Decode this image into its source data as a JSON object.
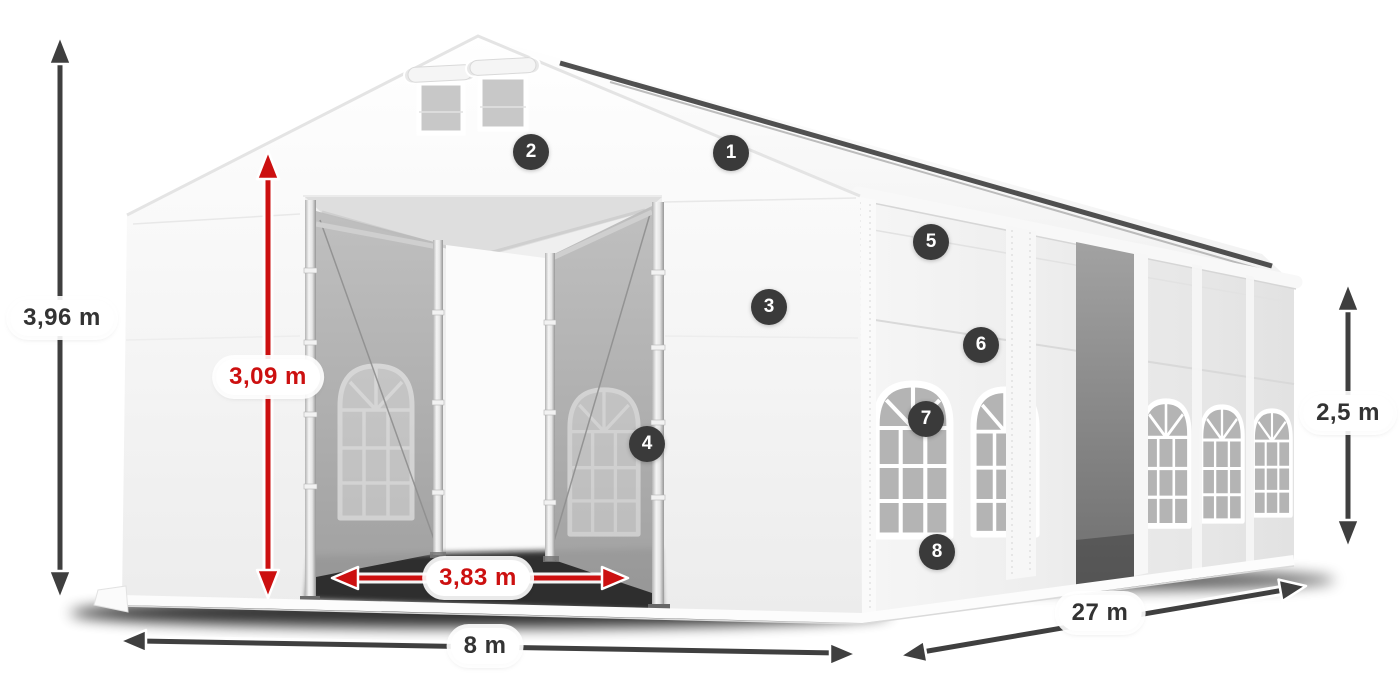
{
  "dimension_labels": {
    "total_height": "3,96 m",
    "entrance_height": "3,09 m",
    "entrance_width": "3,83 m",
    "width": "8 m",
    "length": "27 m",
    "side_height": "2,5 m"
  },
  "markers": [
    {
      "number": "1"
    },
    {
      "number": "2"
    },
    {
      "number": "3"
    },
    {
      "number": "4"
    },
    {
      "number": "5"
    },
    {
      "number": "6"
    },
    {
      "number": "7"
    },
    {
      "number": "8"
    }
  ],
  "colors": {
    "background": "#ffffff",
    "dimension_arrow_dark": "#3f3f3f",
    "dimension_arrow_red": "#cc1010",
    "marker_background": "#3a3a3a",
    "marker_text": "#ffffff",
    "label_background": "#ffffff",
    "label_text_dark": "#333333",
    "label_text_red": "#cc1010",
    "tent_fabric": "#f5f5f5",
    "mesh_panel": "#a9a9a9"
  }
}
